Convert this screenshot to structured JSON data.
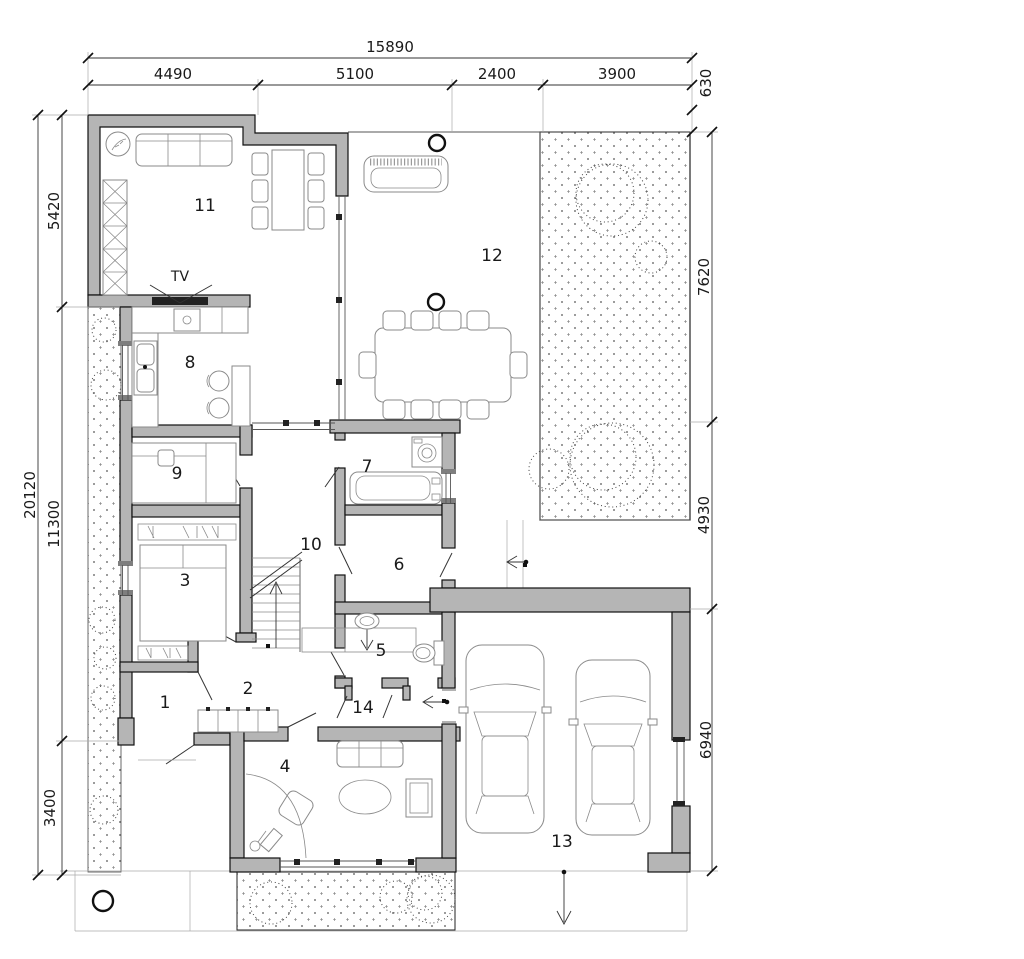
{
  "plan": {
    "title": "single-storey house floor plan with garage",
    "room_labels": [
      "1",
      "2",
      "3",
      "4",
      "5",
      "6",
      "7",
      "8",
      "9",
      "10",
      "11",
      "12",
      "13",
      "14"
    ],
    "tv_label": "TV",
    "dims": {
      "top_total": "15890",
      "top_seg_1": "4490",
      "top_seg_2": "5100",
      "top_seg_3": "2400",
      "top_seg_4": "3900",
      "top_offset": "630",
      "left_total": "20120",
      "left_seg_1": "5420",
      "left_seg_2": "11300",
      "left_seg_3": "3400",
      "right_seg_1": "7620",
      "right_seg_2": "4930",
      "right_seg_3": "6940"
    },
    "colors": {
      "wall": "#b5b5b5",
      "line": "#1a1a1a",
      "ground_dot": "#555"
    }
  }
}
